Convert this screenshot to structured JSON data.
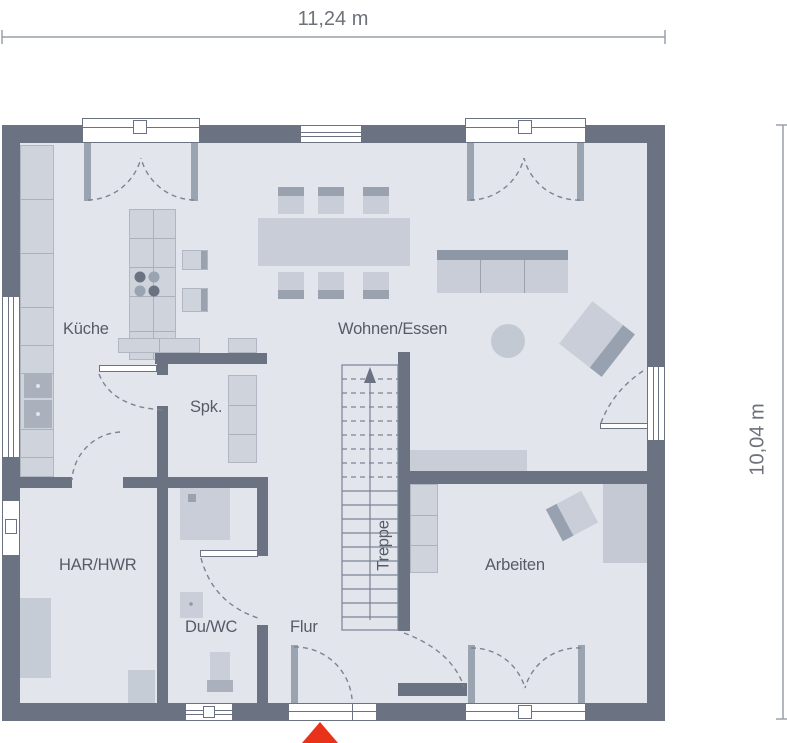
{
  "floorplan": {
    "title": "ground-floor-plan",
    "dimensions": {
      "width_label": "11,24 m",
      "height_label": "10,04 m"
    },
    "rooms": [
      {
        "id": "kueche",
        "label": "Küche"
      },
      {
        "id": "wohnen_essen",
        "label": "Wohnen/Essen"
      },
      {
        "id": "spk",
        "label": "Spk."
      },
      {
        "id": "har_hwr",
        "label": "HAR/HWR"
      },
      {
        "id": "du_wc",
        "label": "Du/WC"
      },
      {
        "id": "flur",
        "label": "Flur"
      },
      {
        "id": "treppe",
        "label": "Treppe"
      },
      {
        "id": "arbeiten",
        "label": "Arbeiten"
      }
    ],
    "furniture_icons": [
      "kitchen-counter",
      "cooktop-island",
      "dining-table",
      "dining-chairs",
      "sofa",
      "coffee-table",
      "armchair",
      "sideboard",
      "pantry-shelf",
      "washer-column",
      "cabinet",
      "shower",
      "washbasin",
      "toilet",
      "stairs-up-arrow",
      "bookshelf",
      "desk",
      "desk-chair"
    ],
    "entrance_marker": "entrance-arrow",
    "colors": {
      "wall": "#6b7383",
      "floor": "#e2e5ec",
      "furniture": "#c9cdd7",
      "furniture_dark": "#9aa2b0",
      "entrance_red": "#e8331a",
      "text": "#565b66"
    }
  }
}
